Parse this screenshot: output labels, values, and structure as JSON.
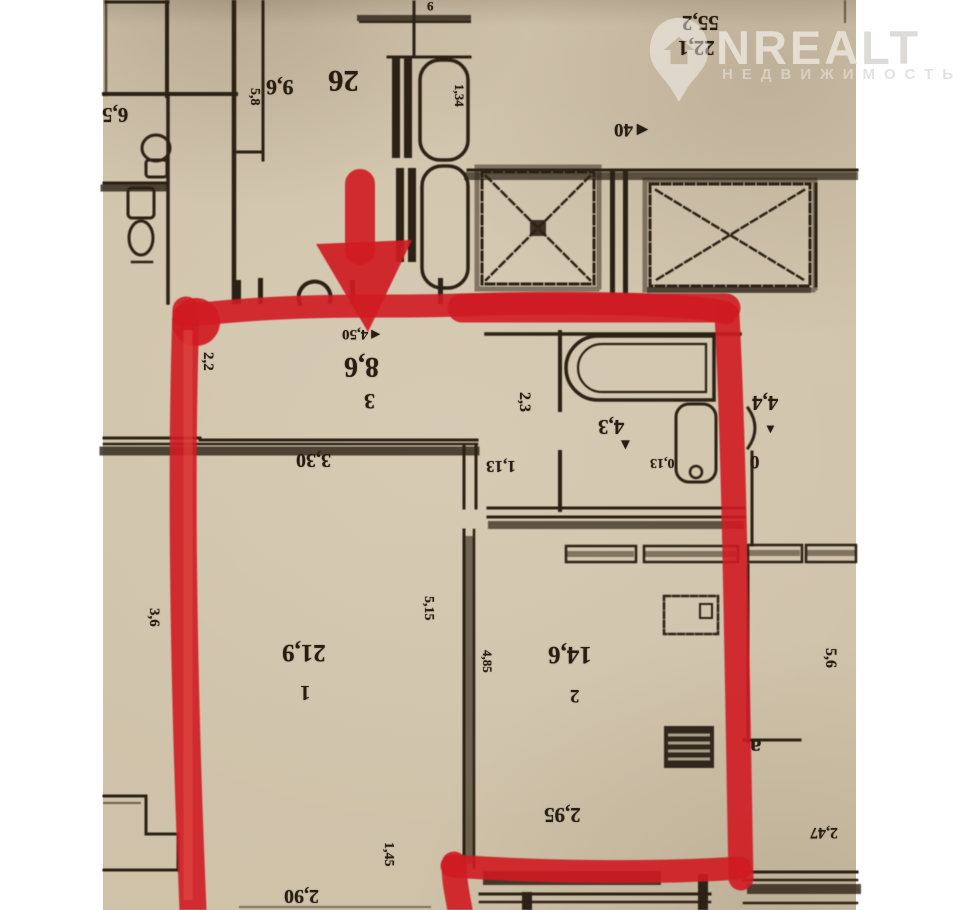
{
  "meta": {
    "kind": "floor-plan-photo",
    "orientation": "plan rotated 180 degrees (numbers upside down)",
    "paper_color": "#d2c5ae",
    "ink_color": "#2b2114",
    "highlight_color": "#cf1b22"
  },
  "watermark": {
    "logo_icon": "location-pin-house-icon",
    "title": "NREALT",
    "subtitle": "НЕДВИЖИМОСТЬ"
  },
  "highlight": {
    "shape": "red marker outline around one apartment",
    "arrow": "red arrow pointing down into top wall of highlighted unit"
  },
  "rooms": [
    {
      "number": "1",
      "area": "21,9"
    },
    {
      "number": "2",
      "area": "14,6"
    },
    {
      "number": "3",
      "area": "8,6"
    }
  ],
  "neighbor_areas": [
    "9,6",
    "26",
    "4,3",
    "4,4",
    "6,5",
    "55,2",
    "22,1"
  ],
  "dimensions": [
    "4,50",
    "3,30",
    "1,13",
    "2,95",
    "2,90",
    "5,15",
    "4,85",
    "1,45",
    "2,2",
    "2,3",
    "3,6",
    "5,6",
    "1,34",
    "5,8",
    "0,13",
    "2,47",
    "40",
    "9",
    "0",
    "а"
  ],
  "labels": [
    {
      "t": "55,2",
      "x": 682,
      "y": 12,
      "s": 21
    },
    {
      "t": "22,1",
      "x": 678,
      "y": 37,
      "s": 21
    },
    {
      "t": "6,5",
      "x": 102,
      "y": 104,
      "s": 21
    },
    {
      "t": "9,6",
      "x": 266,
      "y": 76,
      "s": 22
    },
    {
      "t": "26",
      "x": 328,
      "y": 66,
      "s": 31,
      "b": 1
    },
    {
      "t": "5,8",
      "x": 246,
      "y": 88,
      "s": 14,
      "v": 1
    },
    {
      "t": "1,34",
      "x": 452,
      "y": 84,
      "s": 13,
      "v": 1
    },
    {
      "t": "9",
      "x": 427,
      "y": 0,
      "s": 13
    },
    {
      "t": "◄40",
      "x": 614,
      "y": 120,
      "s": 19
    },
    {
      "t": "◄4,50",
      "x": 342,
      "y": 326,
      "s": 15
    },
    {
      "t": "8,6",
      "x": 344,
      "y": 352,
      "s": 28,
      "b": 1
    },
    {
      "t": "3",
      "x": 364,
      "y": 390,
      "s": 22
    },
    {
      "t": "2,2",
      "x": 198,
      "y": 352,
      "s": 15,
      "v": 1
    },
    {
      "t": "3,30",
      "x": 296,
      "y": 450,
      "s": 20
    },
    {
      "t": "1,13",
      "x": 486,
      "y": 458,
      "s": 17
    },
    {
      "t": "2,3",
      "x": 514,
      "y": 392,
      "s": 16,
      "v": 1
    },
    {
      "t": "4,3",
      "x": 598,
      "y": 416,
      "s": 21
    },
    {
      "t": "0,13",
      "x": 650,
      "y": 455,
      "s": 14
    },
    {
      "t": "4,4",
      "x": 752,
      "y": 392,
      "s": 21,
      "b": 1
    },
    {
      "t": "0",
      "x": 750,
      "y": 452,
      "s": 19,
      "b": 1
    },
    {
      "t": "3,6",
      "x": 144,
      "y": 608,
      "s": 15,
      "v": 1
    },
    {
      "t": "21,9",
      "x": 282,
      "y": 640,
      "s": 25
    },
    {
      "t": "1",
      "x": 300,
      "y": 682,
      "s": 21
    },
    {
      "t": "5,15",
      "x": 420,
      "y": 596,
      "s": 14,
      "v": 1
    },
    {
      "t": "14,6",
      "x": 548,
      "y": 642,
      "s": 25
    },
    {
      "t": "2",
      "x": 570,
      "y": 686,
      "s": 19
    },
    {
      "t": "4,85",
      "x": 480,
      "y": 650,
      "s": 13,
      "v": 1
    },
    {
      "t": "2,95",
      "x": 544,
      "y": 804,
      "s": 21
    },
    {
      "t": "1,45",
      "x": 380,
      "y": 842,
      "s": 14,
      "v": 1
    },
    {
      "t": "2,90",
      "x": 284,
      "y": 886,
      "s": 20
    },
    {
      "t": "2,47",
      "x": 810,
      "y": 824,
      "s": 16
    },
    {
      "t": "5,6",
      "x": 820,
      "y": 648,
      "s": 16,
      "v": 1
    },
    {
      "t": "а",
      "x": 750,
      "y": 736,
      "s": 23,
      "b": 1
    },
    {
      "t": "▼",
      "x": 618,
      "y": 438,
      "s": 15,
      "plain": 1
    },
    {
      "t": "▼",
      "x": 764,
      "y": 422,
      "s": 13,
      "plain": 1
    }
  ]
}
